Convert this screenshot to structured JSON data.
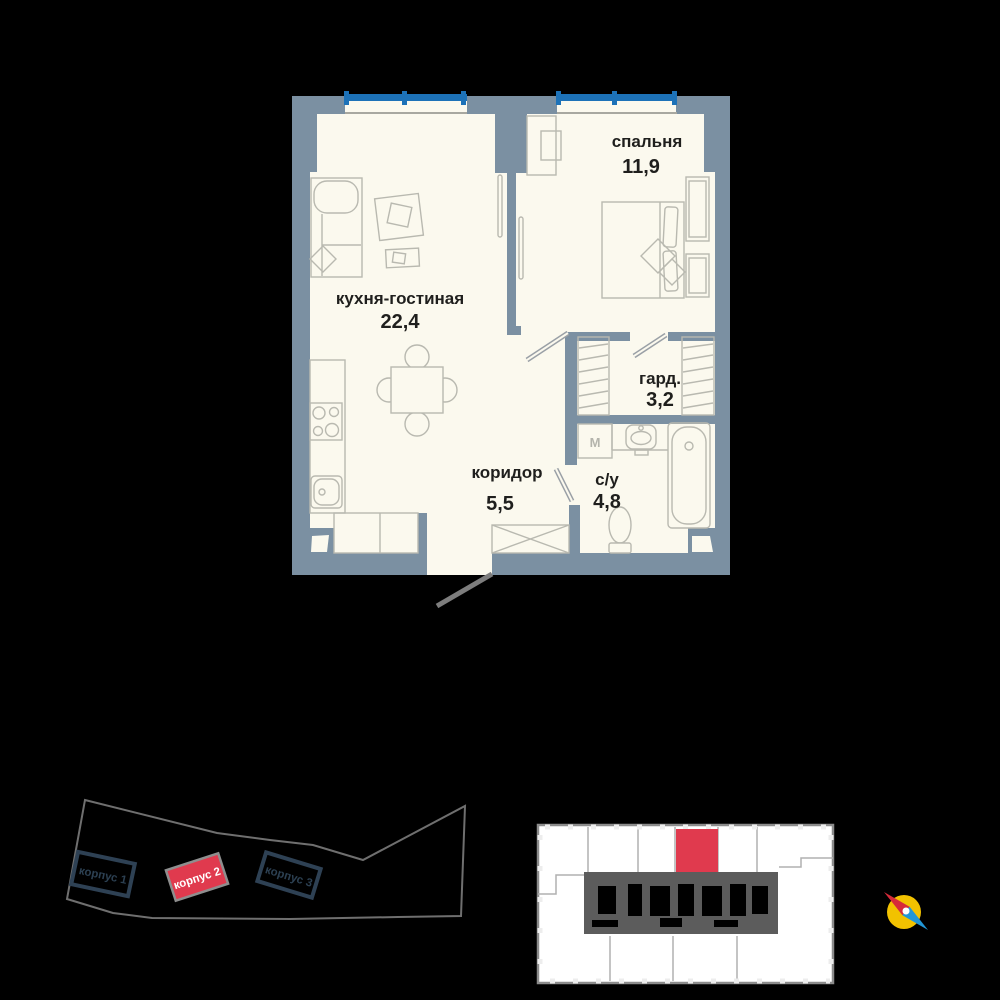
{
  "apartment_plan": {
    "rooms": [
      {
        "name": "кухня-гостиная",
        "area": "22,4"
      },
      {
        "name": "спальня",
        "area": "11,9"
      },
      {
        "name": "гард.",
        "area": "3,2"
      },
      {
        "name": "коридор",
        "area": "5,5"
      },
      {
        "name": "с/у",
        "area": "4,8"
      }
    ],
    "washer_label": "M",
    "colors": {
      "wall": "#7b90a2",
      "floor": "#fbf9ee",
      "window": "#1d72b8"
    }
  },
  "site_plan": {
    "buildings": [
      {
        "label": "корпус 1",
        "highlighted": false
      },
      {
        "label": "корпус 2",
        "highlighted": true
      },
      {
        "label": "корпус 3",
        "highlighted": false
      }
    ],
    "highlight_color": "#e03a4e"
  },
  "floor_overview": {
    "highlighted_unit_color": "#e03a4e"
  },
  "compass": {
    "colors": {
      "circle": "#f2c200",
      "north_needle": "#d62b3a",
      "south_needle": "#2196d6"
    }
  }
}
